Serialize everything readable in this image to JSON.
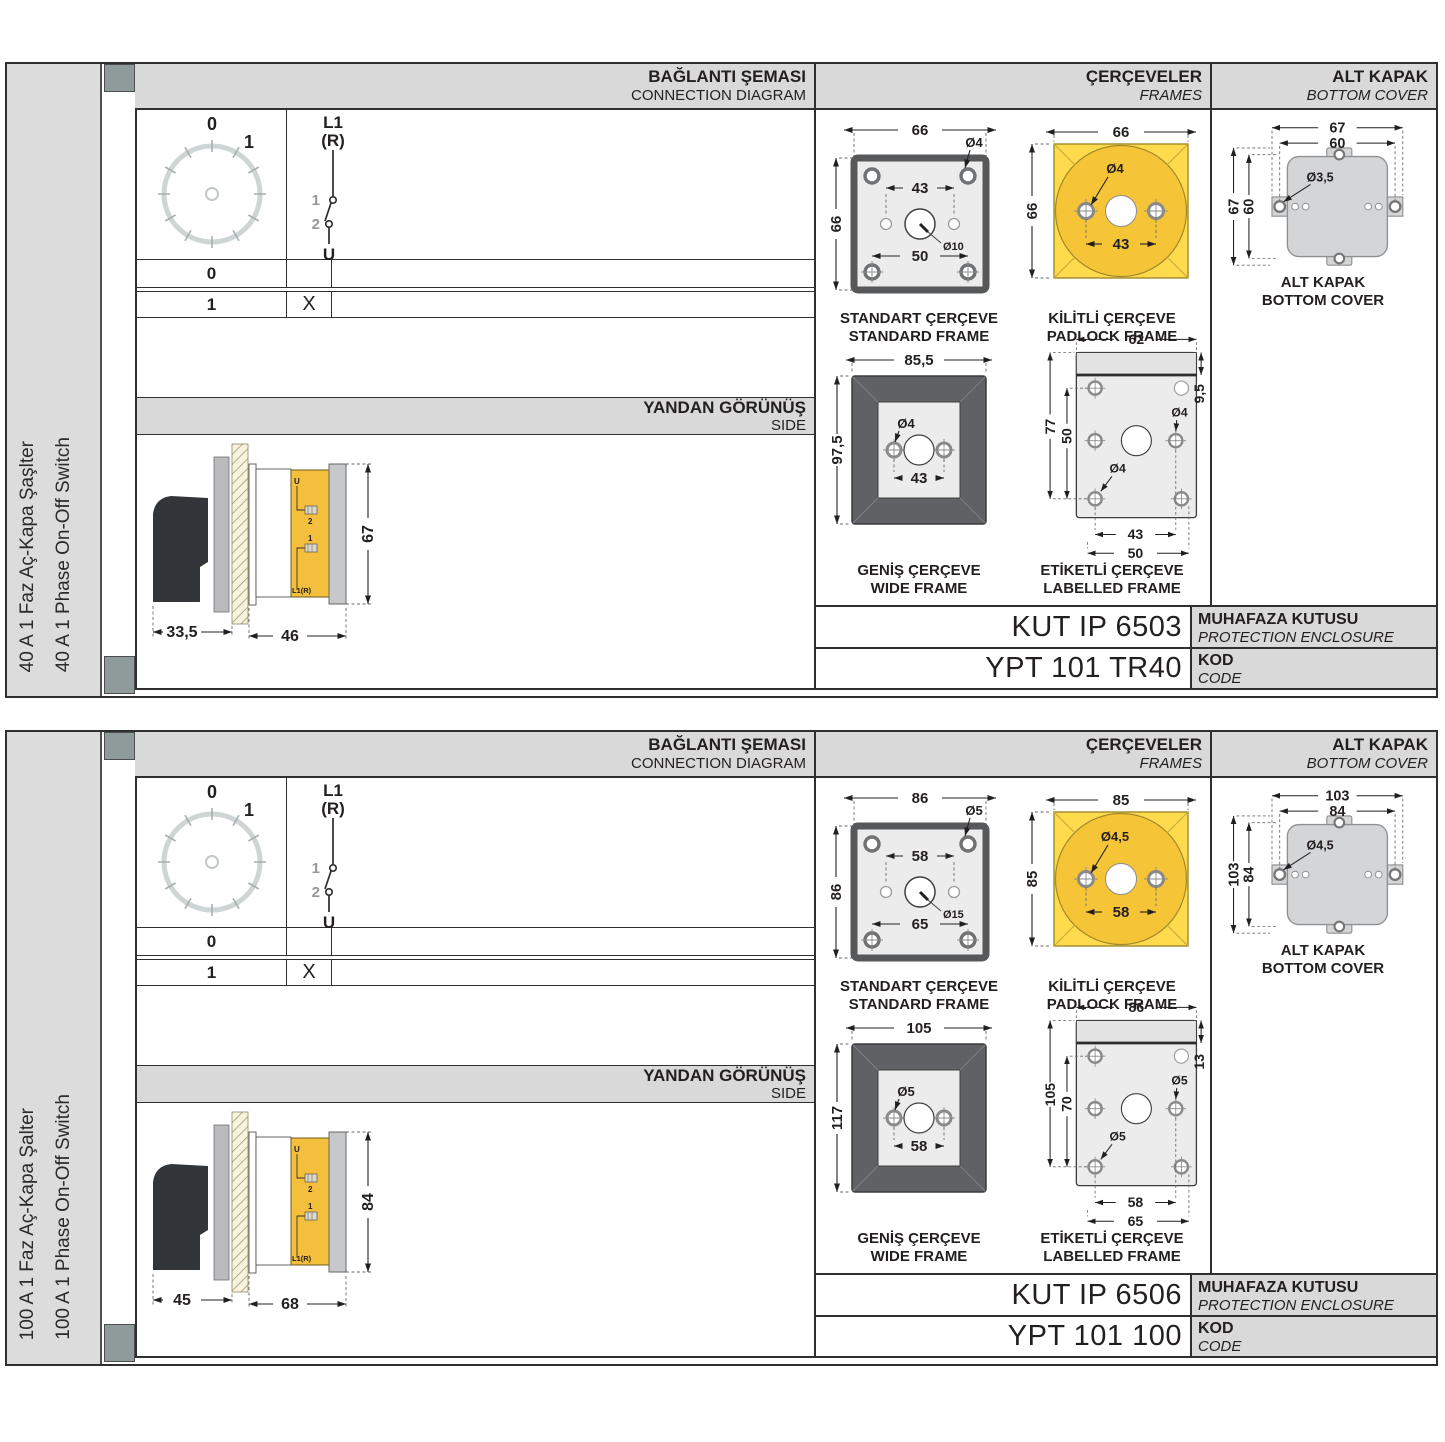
{
  "rows": [
    {
      "sidebar": {
        "title_tr": "40 A 1 Faz Aç-Kapa Şaşlter",
        "title_en": "40 A 1 Phase On-Off Switch"
      },
      "headers": {
        "connection_tr": "BAĞLANTI ŞEMASI",
        "connection_en": "CONNECTION DIAGRAM",
        "frames_tr": "ÇERÇEVELER",
        "frames_en": "FRAMES",
        "cover_tr": "ALT KAPAK",
        "cover_en": "BOTTOM COVER",
        "side_tr": "YANDAN GÖRÜNÜŞ",
        "side_en": "SIDE"
      },
      "connection": {
        "dial": {
          "label_0": "0",
          "label_1": "1"
        },
        "switch": {
          "line1": "L1",
          "line2": "(R)",
          "contact1": "1",
          "contact2": "2",
          "out": "U"
        },
        "table": {
          "row0_pos": "0",
          "row0_mark": "",
          "row1_pos": "1",
          "row1_mark": "X"
        }
      },
      "side_view": {
        "dim_knob": "33,5",
        "dim_body": "46",
        "dim_height": "67",
        "lbl_u": "U",
        "lbl_2": "2",
        "lbl_1": "1",
        "lbl_l1r": "L1(R)"
      },
      "frames": {
        "standard": {
          "dim_w": "66",
          "dim_h": "66",
          "hole": "Ø4",
          "dim_inner": "43",
          "dim_outer": "50",
          "center_hole": "Ø10",
          "caption_tr": "STANDART ÇERÇEVE",
          "caption_en": "STANDARD FRAME"
        },
        "padlock": {
          "dim_w": "66",
          "dim_h": "66",
          "hole": "Ø4",
          "dim_inner": "43",
          "caption_tr": "KİLİTLİ ÇERÇEVE",
          "caption_en": "PADLOCK FRAME"
        },
        "wide": {
          "dim_w": "85,5",
          "dim_h": "97,5",
          "hole": "Ø4",
          "dim_inner": "43",
          "caption_tr": "GENİŞ ÇERÇEVE",
          "caption_en": "WIDE FRAME"
        },
        "labelled": {
          "dim_w": "62",
          "dim_strip": "9,5",
          "dim_h": "77",
          "dim_inner_h": "50",
          "hole_a": "Ø4",
          "hole_b": "Ø4",
          "dim_inner": "43",
          "dim_outer": "50",
          "caption_tr": "ETİKETLİ ÇERÇEVE",
          "caption_en": "LABELLED FRAME"
        }
      },
      "cover": {
        "dim_w1": "67",
        "dim_w2": "60",
        "dim_h1": "67",
        "dim_h2": "60",
        "hole": "Ø3,5",
        "caption_tr": "ALT KAPAK",
        "caption_en": "BOTTOM COVER"
      },
      "codes": {
        "enclosure_value": "KUT IP 6503",
        "enclosure_tr": "MUHAFAZA KUTUSU",
        "enclosure_en": "PROTECTION ENCLOSURE",
        "code_value": "YPT 101 TR40",
        "code_tr": "KOD",
        "code_en": "CODE"
      }
    },
    {
      "sidebar": {
        "title_tr": "100 A 1 Faz Aç-Kapa Şalter",
        "title_en": "100 A 1 Phase On-Off Switch"
      },
      "headers": {
        "connection_tr": "BAĞLANTI ŞEMASI",
        "connection_en": "CONNECTION DIAGRAM",
        "frames_tr": "ÇERÇEVELER",
        "frames_en": "FRAMES",
        "cover_tr": "ALT KAPAK",
        "cover_en": "BOTTOM COVER",
        "side_tr": "YANDAN GÖRÜNÜŞ",
        "side_en": "SIDE"
      },
      "connection": {
        "dial": {
          "label_0": "0",
          "label_1": "1"
        },
        "switch": {
          "line1": "L1",
          "line2": "(R)",
          "contact1": "1",
          "contact2": "2",
          "out": "U"
        },
        "table": {
          "row0_pos": "0",
          "row0_mark": "",
          "row1_pos": "1",
          "row1_mark": "X"
        }
      },
      "side_view": {
        "dim_knob": "45",
        "dim_body": "68",
        "dim_height": "84",
        "lbl_u": "U",
        "lbl_2": "2",
        "lbl_1": "1",
        "lbl_l1r": "L1(R)"
      },
      "frames": {
        "standard": {
          "dim_w": "86",
          "dim_h": "86",
          "hole": "Ø5",
          "dim_inner": "58",
          "dim_outer": "65",
          "center_hole": "Ø15",
          "caption_tr": "STANDART ÇERÇEVE",
          "caption_en": "STANDARD FRAME"
        },
        "padlock": {
          "dim_w": "85",
          "dim_h": "85",
          "hole": "Ø4,5",
          "dim_inner": "58",
          "caption_tr": "KİLİTLİ ÇERÇEVE",
          "caption_en": "PADLOCK FRAME"
        },
        "wide": {
          "dim_w": "105",
          "dim_h": "117",
          "hole": "Ø5",
          "dim_inner": "58",
          "caption_tr": "GENİŞ ÇERÇEVE",
          "caption_en": "WIDE FRAME"
        },
        "labelled": {
          "dim_w": "86",
          "dim_strip": "13",
          "dim_h": "105",
          "dim_inner_h": "70",
          "hole_a": "Ø5",
          "hole_b": "Ø5",
          "dim_inner": "58",
          "dim_outer": "65",
          "caption_tr": "ETİKETLİ ÇERÇEVE",
          "caption_en": "LABELLED FRAME"
        }
      },
      "cover": {
        "dim_w1": "103",
        "dim_w2": "84",
        "dim_h1": "103",
        "dim_h2": "84",
        "hole": "Ø4,5",
        "caption_tr": "ALT KAPAK",
        "caption_en": "BOTTOM COVER"
      },
      "codes": {
        "enclosure_value": "KUT IP 6506",
        "enclosure_tr": "MUHAFAZA KUTUSU",
        "enclosure_en": "PROTECTION ENCLOSURE",
        "code_value": "YPT 101 100",
        "code_tr": "KOD",
        "code_en": "CODE"
      }
    }
  ]
}
